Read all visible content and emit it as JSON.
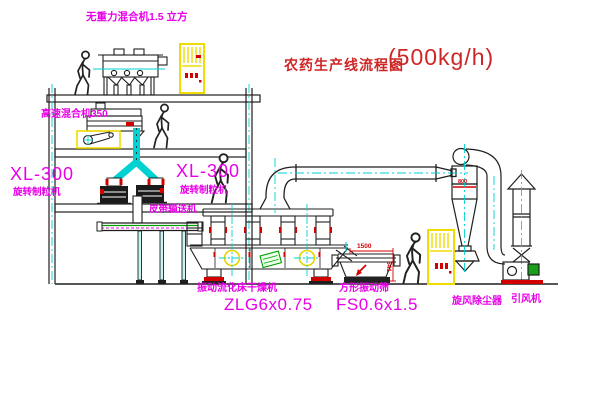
{
  "title": {
    "name": "农药生产线流程图",
    "capacity": "(500kg/h)"
  },
  "labels": {
    "gravity_mixer": "无重力混合机1.5 立方",
    "high_speed_mixer": "高速混合机350",
    "granulator_left_model": "XL-300",
    "granulator_left_name": "旋转制粒机",
    "granulator_mid_model": "XL-300",
    "granulator_mid_name": "旋转制粒机",
    "belt_conveyor": "皮带输送机",
    "dryer_name": "振动流化床干燥机",
    "dryer_model": "ZLG6x0.75",
    "screen_name": "方形振动筛",
    "screen_model": "FS0.6x1.5",
    "cyclone": "旋风除尘器",
    "induced_draft_fan": "引风机"
  },
  "dimensions": {
    "screen_length": "1500",
    "screen_height": "541",
    "cyclone_note": "800"
  },
  "colors": {
    "label_magenta": "#e800e8",
    "title_red": "#cf2626",
    "dim_red": "#d40000",
    "pipe_cyan": "#00d2d2",
    "cabinet_yellow": "#f0dc00",
    "machine_green": "#00a000",
    "line_black": "#1f1f1f"
  }
}
